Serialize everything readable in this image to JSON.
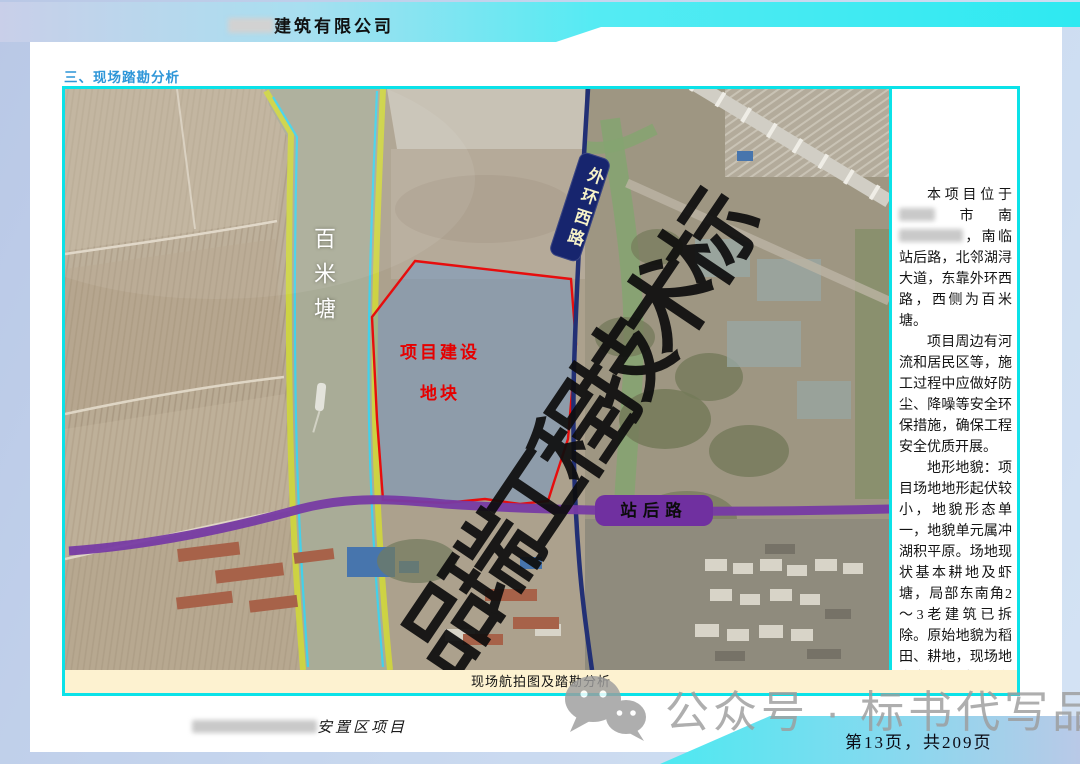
{
  "colors": {
    "accent_cyan": "#0be2e8",
    "heading_blue": "#2e96d8",
    "road_navy": "#17256e",
    "road_purple": "#7030a0",
    "plot_red": "#e60000",
    "caption_bg": "#fdf2d0",
    "bank_yellow": "#ccd335",
    "bank_cyan": "#39cfe9",
    "plot_fill": "rgba(104,146,198,0.5)",
    "watermark_gray": "#9d9d9d"
  },
  "header": {
    "company_segments": [
      {
        "redact": 46
      },
      {
        "text": "建筑有限公司"
      }
    ]
  },
  "section_title": "三、现场踏勘分析",
  "map": {
    "caption": "现场航拍图及踏勘分析",
    "watermark": "品瑞工程技术标",
    "labels": {
      "river": "百米塘",
      "road_vertical": "外环西路",
      "road_horizontal": "站后路",
      "plot_line1": "项目建设",
      "plot_line2": "地块"
    },
    "icons": {
      "boat": "boat-icon",
      "bridge": "viaduct-bridge"
    }
  },
  "sidebar": {
    "paragraphs": [
      {
        "segments": [
          {
            "text": "本项目位于"
          },
          {
            "redact": 36
          },
          {
            "text": "市南"
          },
          {
            "redact": 64
          },
          {
            "text": "，南临站后路，北邻湖浔大道，东靠外环西路，西侧为百米塘。"
          }
        ]
      },
      {
        "segments": [
          {
            "text": "项目周边有河流和居民区等，施工过程中应做好防尘、降噪等安全环保措施，确保工程安全优质开展。"
          }
        ]
      },
      {
        "segments": [
          {
            "text": "地形地貌：项目场地地形起伏较小，地貌形态单一，地貌单元属冲湖积平原。场地现状基本耕地及虾塘，局部东南角2～3老建筑已拆除。原始地貌为稻田、耕地，现场地自然地面标高在1.20～2.00m之间。"
          }
        ]
      }
    ]
  },
  "footer": {
    "project_segments": [
      {
        "redact": 125
      },
      {
        "text": "安置区项目"
      }
    ],
    "page_info": "第13页，共209页",
    "social_watermark": "公众号 · 标书代写品瑞"
  }
}
